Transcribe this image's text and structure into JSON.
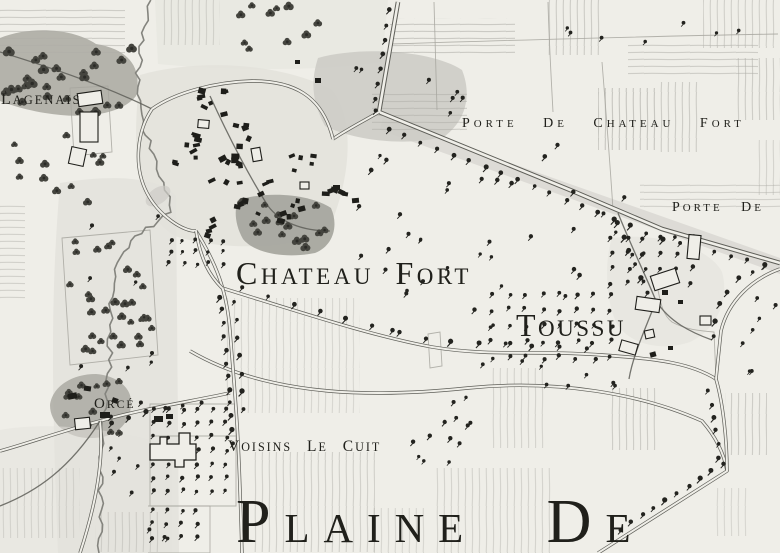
{
  "map": {
    "labels": [
      {
        "id": "lagenais",
        "text": "Lagenais",
        "x": 1,
        "y": 104,
        "size": 16,
        "spacing": 2,
        "word_spacing": 0,
        "rest_scale": 0.78
      },
      {
        "id": "porte-de-chateau-fort",
        "text": "Porte de Chateau Fort",
        "x": 462,
        "y": 127,
        "size": 14,
        "spacing": 4,
        "word_spacing": 18,
        "rest_scale": 0.78
      },
      {
        "id": "porte-de",
        "text": "Porte de",
        "x": 672,
        "y": 211,
        "size": 14,
        "spacing": 3,
        "word_spacing": 12,
        "rest_scale": 0.78
      },
      {
        "id": "chateau-fort",
        "text": "Chateau Fort",
        "x": 236,
        "y": 284,
        "size": 32,
        "spacing": 3.5,
        "word_spacing": 10,
        "rest_scale": 0.72
      },
      {
        "id": "toussu",
        "text": "Toussu",
        "x": 516,
        "y": 336,
        "size": 32,
        "spacing": 2.5,
        "word_spacing": 0,
        "rest_scale": 0.72
      },
      {
        "id": "orce",
        "text": "Orcé",
        "x": 94,
        "y": 408,
        "size": 15,
        "spacing": 2,
        "word_spacing": 0,
        "rest_scale": 0.78
      },
      {
        "id": "voisins-le-cuit",
        "text": "Voisins le Cuit",
        "x": 228,
        "y": 451,
        "size": 15.5,
        "spacing": 2,
        "word_spacing": 9,
        "rest_scale": 0.78
      },
      {
        "id": "plaine-de",
        "text": "Plaine de",
        "x": 236,
        "y": 542,
        "size": 62,
        "spacing": 14,
        "word_spacing": 40,
        "rest_scale": 0.66
      }
    ],
    "colors": {
      "paper": "#efeee8",
      "ink": "#1e1e1a",
      "tree": "#23231f",
      "woods_tree": "#45453f",
      "woods": "#b0afa8",
      "wash_light": "#e3e2dc",
      "wash_mid": "#cdccc6",
      "wash_dark": "#a7a69f",
      "hatch": "#aeada7",
      "road": "#5e5e58",
      "stream": "#84847e"
    }
  }
}
